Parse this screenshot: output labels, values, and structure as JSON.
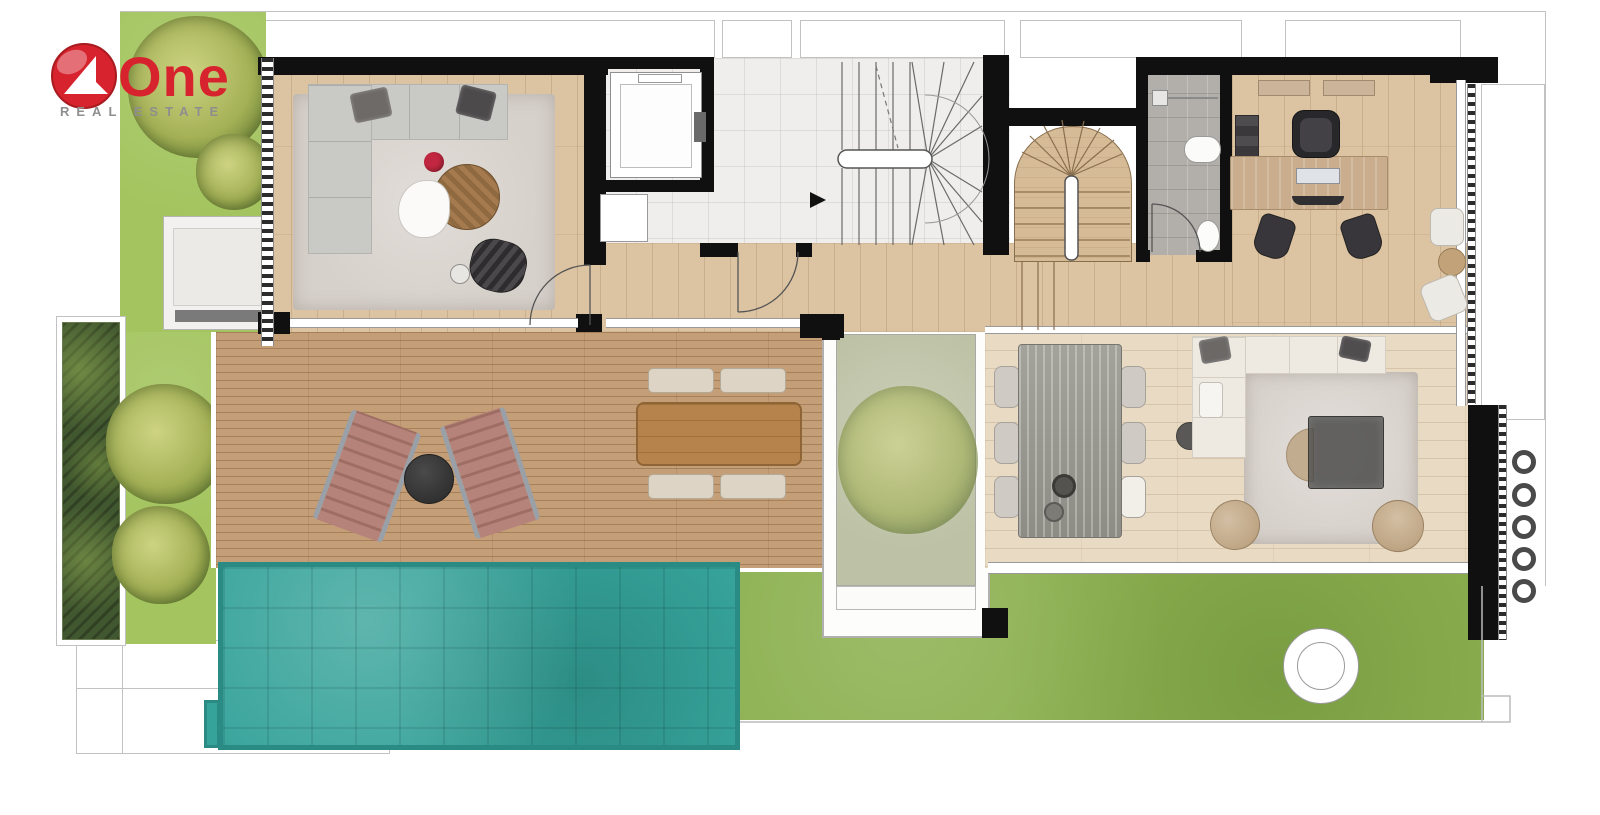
{
  "logo": {
    "title": "One",
    "subtitle": "REAL ESTATE"
  },
  "colors": {
    "wall": "#101010",
    "line": "#c2c2c2",
    "wood": "#dcc3a2",
    "wood_light": "#e8dac3",
    "deck": "#c49e77",
    "marble": "#efeeec",
    "bath_tile": "#b2aeaa",
    "lawn": "#8cb04f",
    "grass": "#a3c45e",
    "planting": "#41572f",
    "tree": "#a4b156",
    "tree_dark": "#7c9040",
    "pool": "#36a39a",
    "pool_edge": "#2a8a84",
    "courtyard": "#bdc2a6",
    "rug": "#d7d1cb",
    "sofa_gray": "#c9c9c6",
    "sofa_white": "#efeae1",
    "stone": "#9b9b95",
    "desk": "#c9ad8c",
    "lounger": "#b5837a",
    "cushion": "#ddd4c5",
    "outdoor_table": "#b5834b",
    "dark": "#3a3a3a",
    "accent_red": "#c22741",
    "logo_red": "#d7232e",
    "logo_gray": "#8e8e8e"
  },
  "floorplan": {
    "rooms": [
      "living-room",
      "elevator",
      "lobby",
      "main-staircase",
      "wood-staircase",
      "bathroom",
      "office",
      "hallway",
      "dining-area",
      "lounge",
      "courtyard",
      "terrace-deck",
      "swimming-pool",
      "lawn",
      "garden"
    ]
  }
}
